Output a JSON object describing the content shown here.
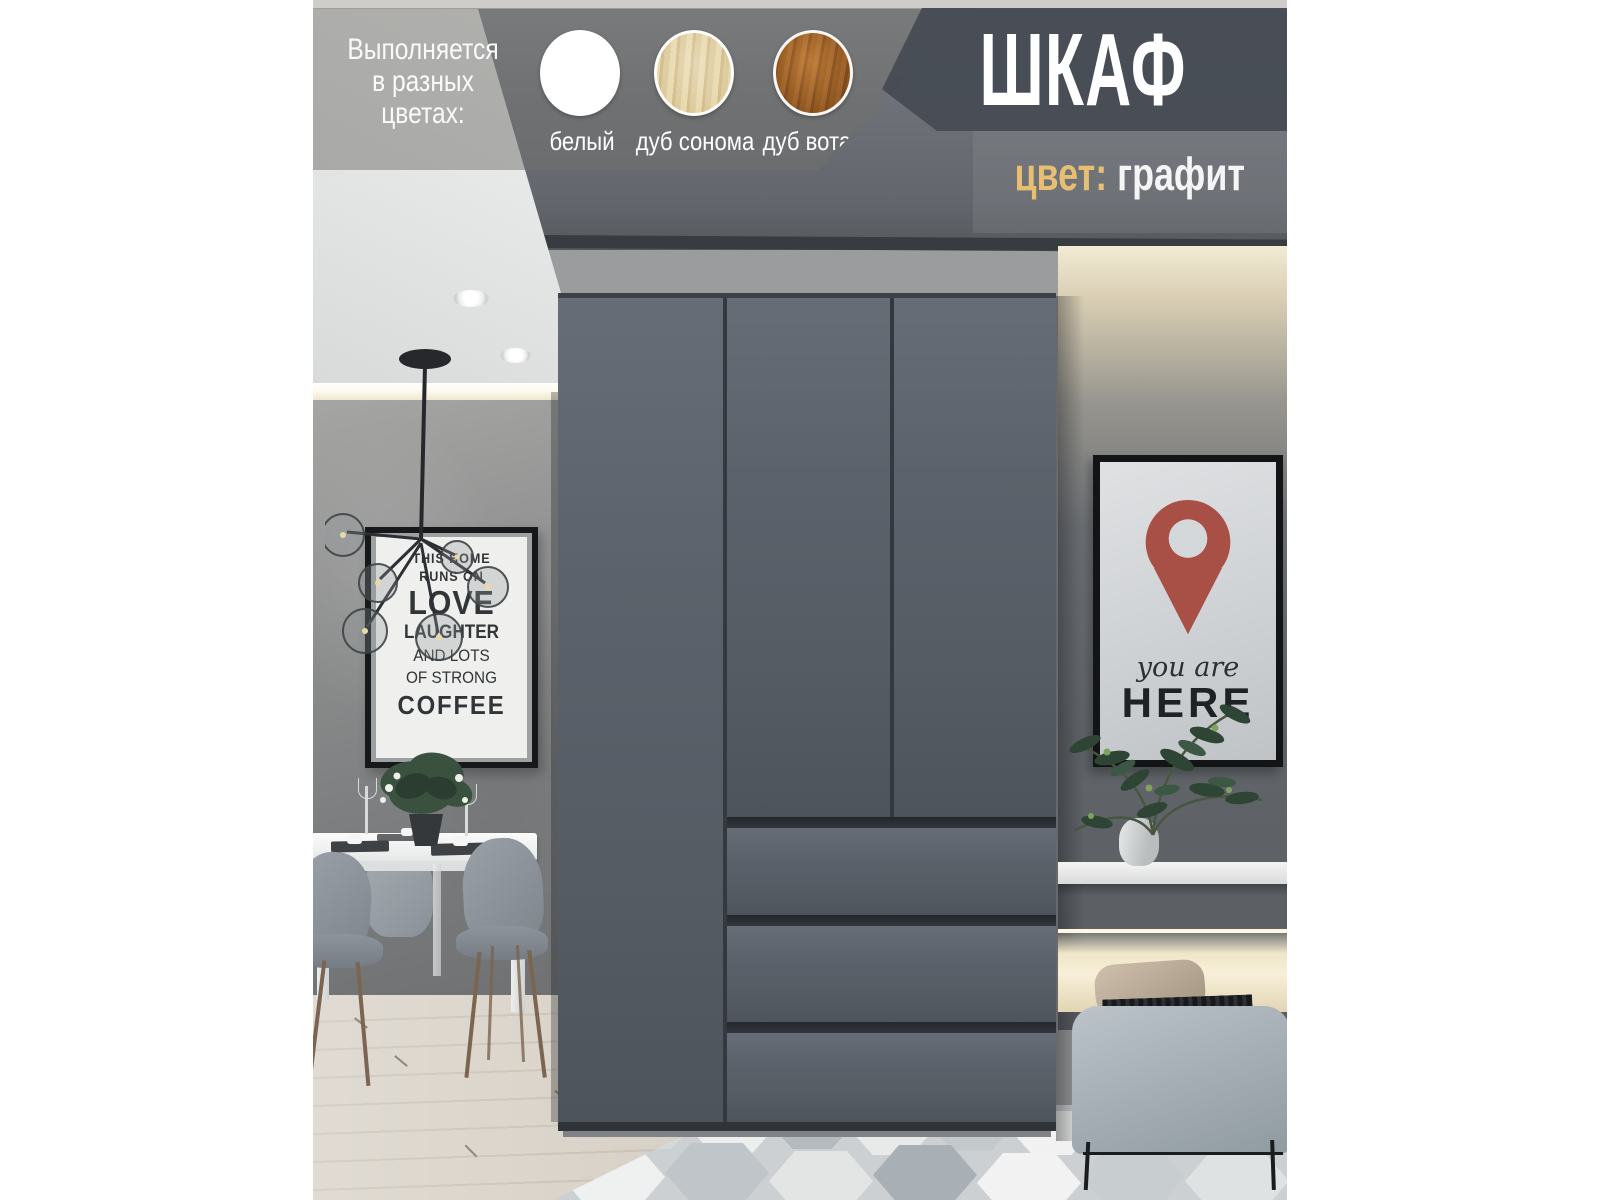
{
  "product": {
    "title": "ШКАФ",
    "color_label": "цвет:",
    "color_value": "графит"
  },
  "color_options": {
    "heading_lines": [
      "Выполняется",
      "в разных",
      "цветах:"
    ],
    "swatches": [
      {
        "name": "белый",
        "color": "#ffffff"
      },
      {
        "name": "дуб сонома",
        "color": "#d9c28e"
      },
      {
        "name": "дуб вотан",
        "color": "#a5601f"
      }
    ]
  },
  "accent_colors": {
    "gold": "#e8bf70",
    "banner_gray": "#474c54",
    "wardrobe_graphite": "#575d65",
    "pin_red": "#a84f46"
  },
  "scene": {
    "coffee_poster": {
      "lines": [
        "THIS HOME",
        "RUNS ON",
        "LOVE",
        "LAUGHTER",
        "AND LOTS",
        "OF STRONG",
        "COFFEE"
      ]
    },
    "here_poster": {
      "script_line": "you are",
      "caption_line": "HERE"
    }
  }
}
